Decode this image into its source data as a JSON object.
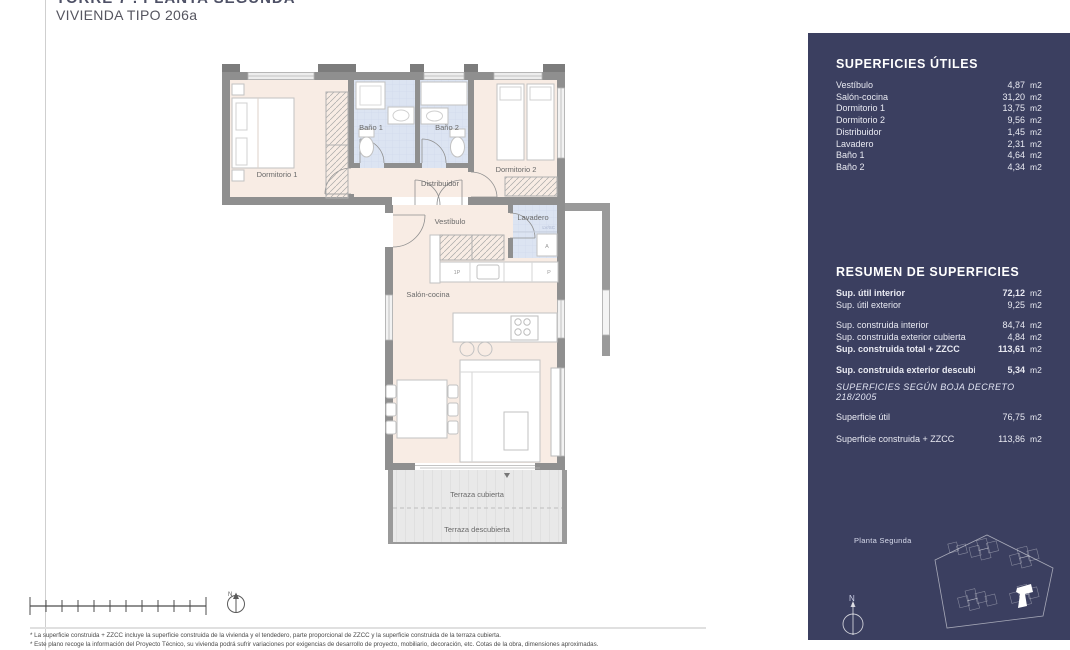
{
  "header": {
    "project_title": "TORRE 7 . PLANTA SEGUNDA",
    "unit_title": "VIVIENDA TIPO 206a"
  },
  "plan": {
    "labels": {
      "dormitorio1": "Dormitorio 1",
      "bano1": "Baño 1",
      "bano2": "Baño 2",
      "dormitorio2": "Dormitorio 2",
      "distribuidor": "Distribuidor",
      "vestibulo": "Vestíbulo",
      "lavadero": "Lavadero",
      "lvsc": "LV/SC",
      "appliance_a": "A",
      "cab_1p": "1P",
      "cab_p": "P",
      "salon": "Salón-cocina",
      "terraza_cubierta": "Terraza cubierta",
      "terraza_descubierta": "Terraza descubierta"
    },
    "compass_north": "N"
  },
  "sidebar": {
    "superficies_utiles": {
      "title": "SUPERFICIES ÚTILES",
      "rows": [
        {
          "label": "Vestíbulo",
          "value": "4,87",
          "unit": "m2"
        },
        {
          "label": "Salón-cocina",
          "value": "31,20",
          "unit": "m2"
        },
        {
          "label": "Dormitorio 1",
          "value": "13,75",
          "unit": "m2"
        },
        {
          "label": "Dormitorio 2",
          "value": "9,56",
          "unit": "m2"
        },
        {
          "label": "Distribuidor",
          "value": "1,45",
          "unit": "m2"
        },
        {
          "label": "Lavadero",
          "value": "2,31",
          "unit": "m2"
        },
        {
          "label": "Baño 1",
          "value": "4,64",
          "unit": "m2"
        },
        {
          "label": "Baño 2",
          "value": "4,34",
          "unit": "m2"
        }
      ]
    },
    "resumen": {
      "title": "RESUMEN  DE SUPERFICIES",
      "rows": [
        {
          "label": "Sup. útil interior",
          "value": "72,12",
          "unit": "m2"
        },
        {
          "label": "Sup. útil exterior",
          "value": "9,25",
          "unit": "m2"
        },
        {
          "label": "Sup. construida interior",
          "value": "84,74",
          "unit": "m2"
        },
        {
          "label": "Sup. construida exterior cubierta",
          "value": "4,84",
          "unit": "m2"
        },
        {
          "label": "Sup. construida total + ZZCC",
          "value": "113,61",
          "unit": "m2"
        },
        {
          "label": "Sup. construida exterior descubierta",
          "value": "5,34",
          "unit": "m2"
        }
      ]
    },
    "boja": {
      "title": "SUPERFICIES SEGÚN BOJA DECRETO 218/2005",
      "rows": [
        {
          "label": "Superficie útil",
          "value": "76,75",
          "unit": "m2"
        },
        {
          "label": "Superficie construida + ZZCC",
          "value": "113,86",
          "unit": "m2"
        }
      ]
    },
    "floor_label": "Planta Segunda",
    "compass_north": "N"
  },
  "footer": {
    "note1": "* La superficie construida + ZZCC incluye la superficie construida de la vivienda y el tendedero, parte proporcional de ZZCC y la superficie construida de la terraza cubierta.",
    "note2": "* Este plano recoge la información del Proyecto Técnico, su vivienda podrá sufrir variaciones por exigencias de desarrollo de proyecto, mobiliario, decoración, etc. Cotas de la obra, dimensiones aproximadas."
  },
  "colors": {
    "sidebar_bg": "#3b3f60",
    "floor_pink": "#f8ece4",
    "floor_blue": "#dce4f2",
    "wall_gray": "#8f8f8f",
    "terrace_gray": "#e9e9e9"
  }
}
